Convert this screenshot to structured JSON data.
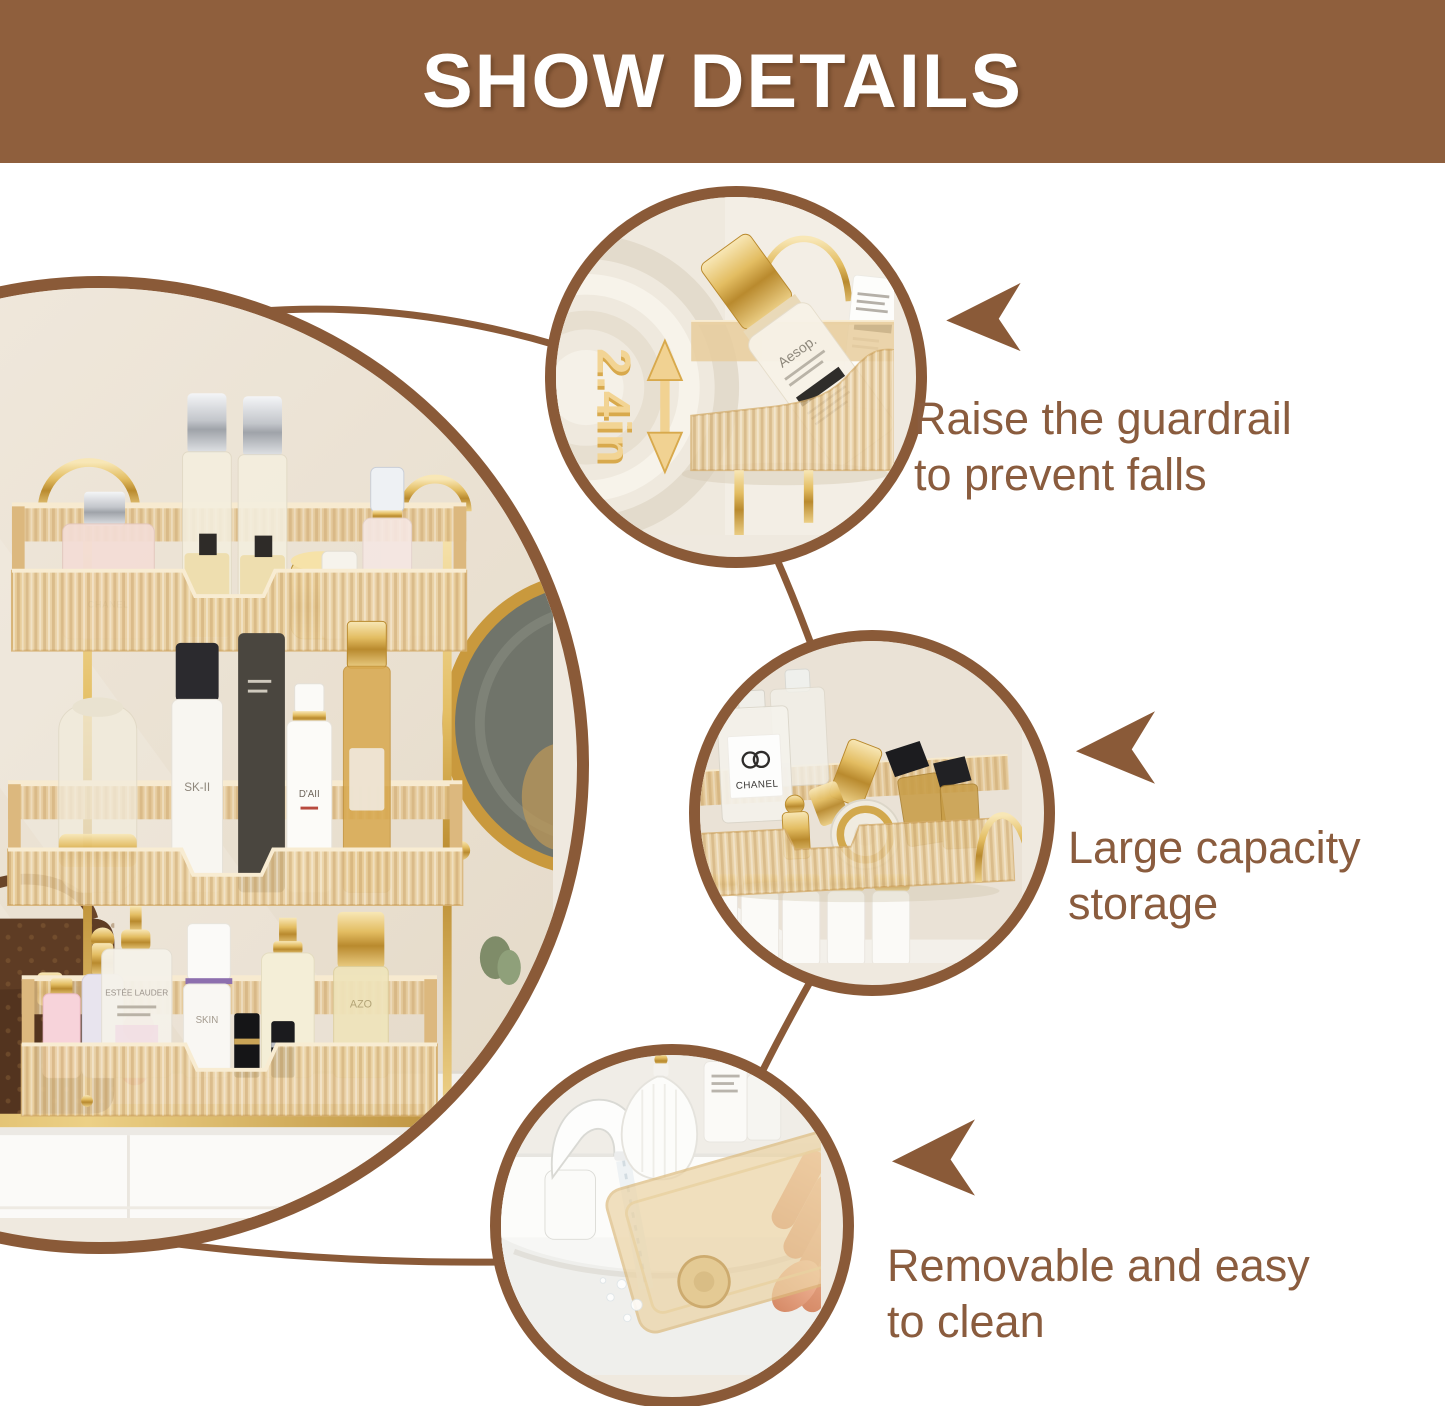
{
  "header": {
    "title": "SHOW DETAILS"
  },
  "callouts": [
    {
      "name": "raise-guardrail",
      "text": "Raise the guardrail to prevent falls",
      "measurement": "2.4in"
    },
    {
      "name": "large-capacity",
      "text": "Large capacity storage"
    },
    {
      "name": "removable-clean",
      "text": "Removable and easy to clean"
    }
  ],
  "product_labels": {
    "aesop": "Aesop.",
    "chanel": "CHANEL",
    "sk2": "SK-II",
    "daii": "D'AII",
    "estee": "ESTÉE LAUDER",
    "skin": "SKIN",
    "azo": "AZO"
  },
  "colors": {
    "banner_brown": "#8F5F3D",
    "accent_brown": "#8A5A38",
    "text_brown": "#8A5C3E",
    "gold": "#F1D292",
    "amber_tray": "#EACF9E"
  }
}
